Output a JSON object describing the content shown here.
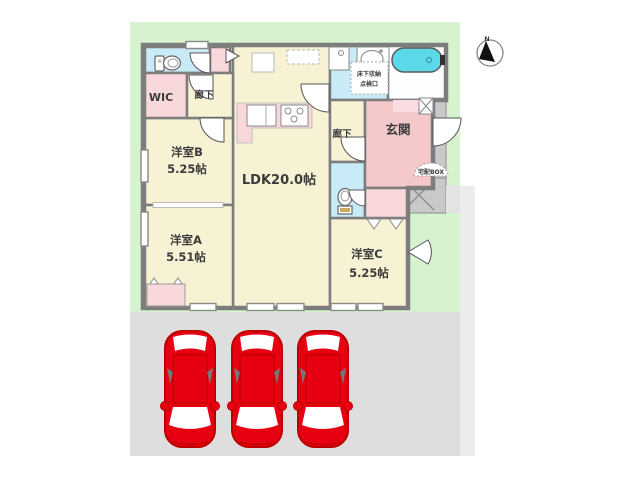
{
  "rooms": {
    "wic": {
      "label": "WIC"
    },
    "hallway_upper": {
      "label": "廊下"
    },
    "hallway_entry": {
      "label": "廊下"
    },
    "bedroom_b": {
      "name": "洋室B",
      "area": "5.25帖"
    },
    "bedroom_a": {
      "name": "洋室A",
      "area": "5.51帖"
    },
    "bedroom_c": {
      "name": "洋室C",
      "area": "5.25帖"
    },
    "ldk": {
      "label": "LDK20.0帖"
    },
    "entrance": {
      "label": "玄関"
    }
  },
  "annotations": {
    "underfloor_storage": "床下収納",
    "inspection_hatch": "点検口",
    "delivery_box": "宅配BOX",
    "compass_north": "N"
  },
  "parking": {
    "spaces": 3
  },
  "colors": {
    "lawn": "#d6f2cf",
    "parking_lot": "#dedede",
    "room_floor": "#f6f2d3",
    "wet_area": "#c9eaf7",
    "entrance_pink": "#f5c9ca",
    "closet_pink": "#f8d8da",
    "bathtub": "#5cd9e9",
    "wall": "#7d7d7d",
    "car_red": "#e60012"
  }
}
